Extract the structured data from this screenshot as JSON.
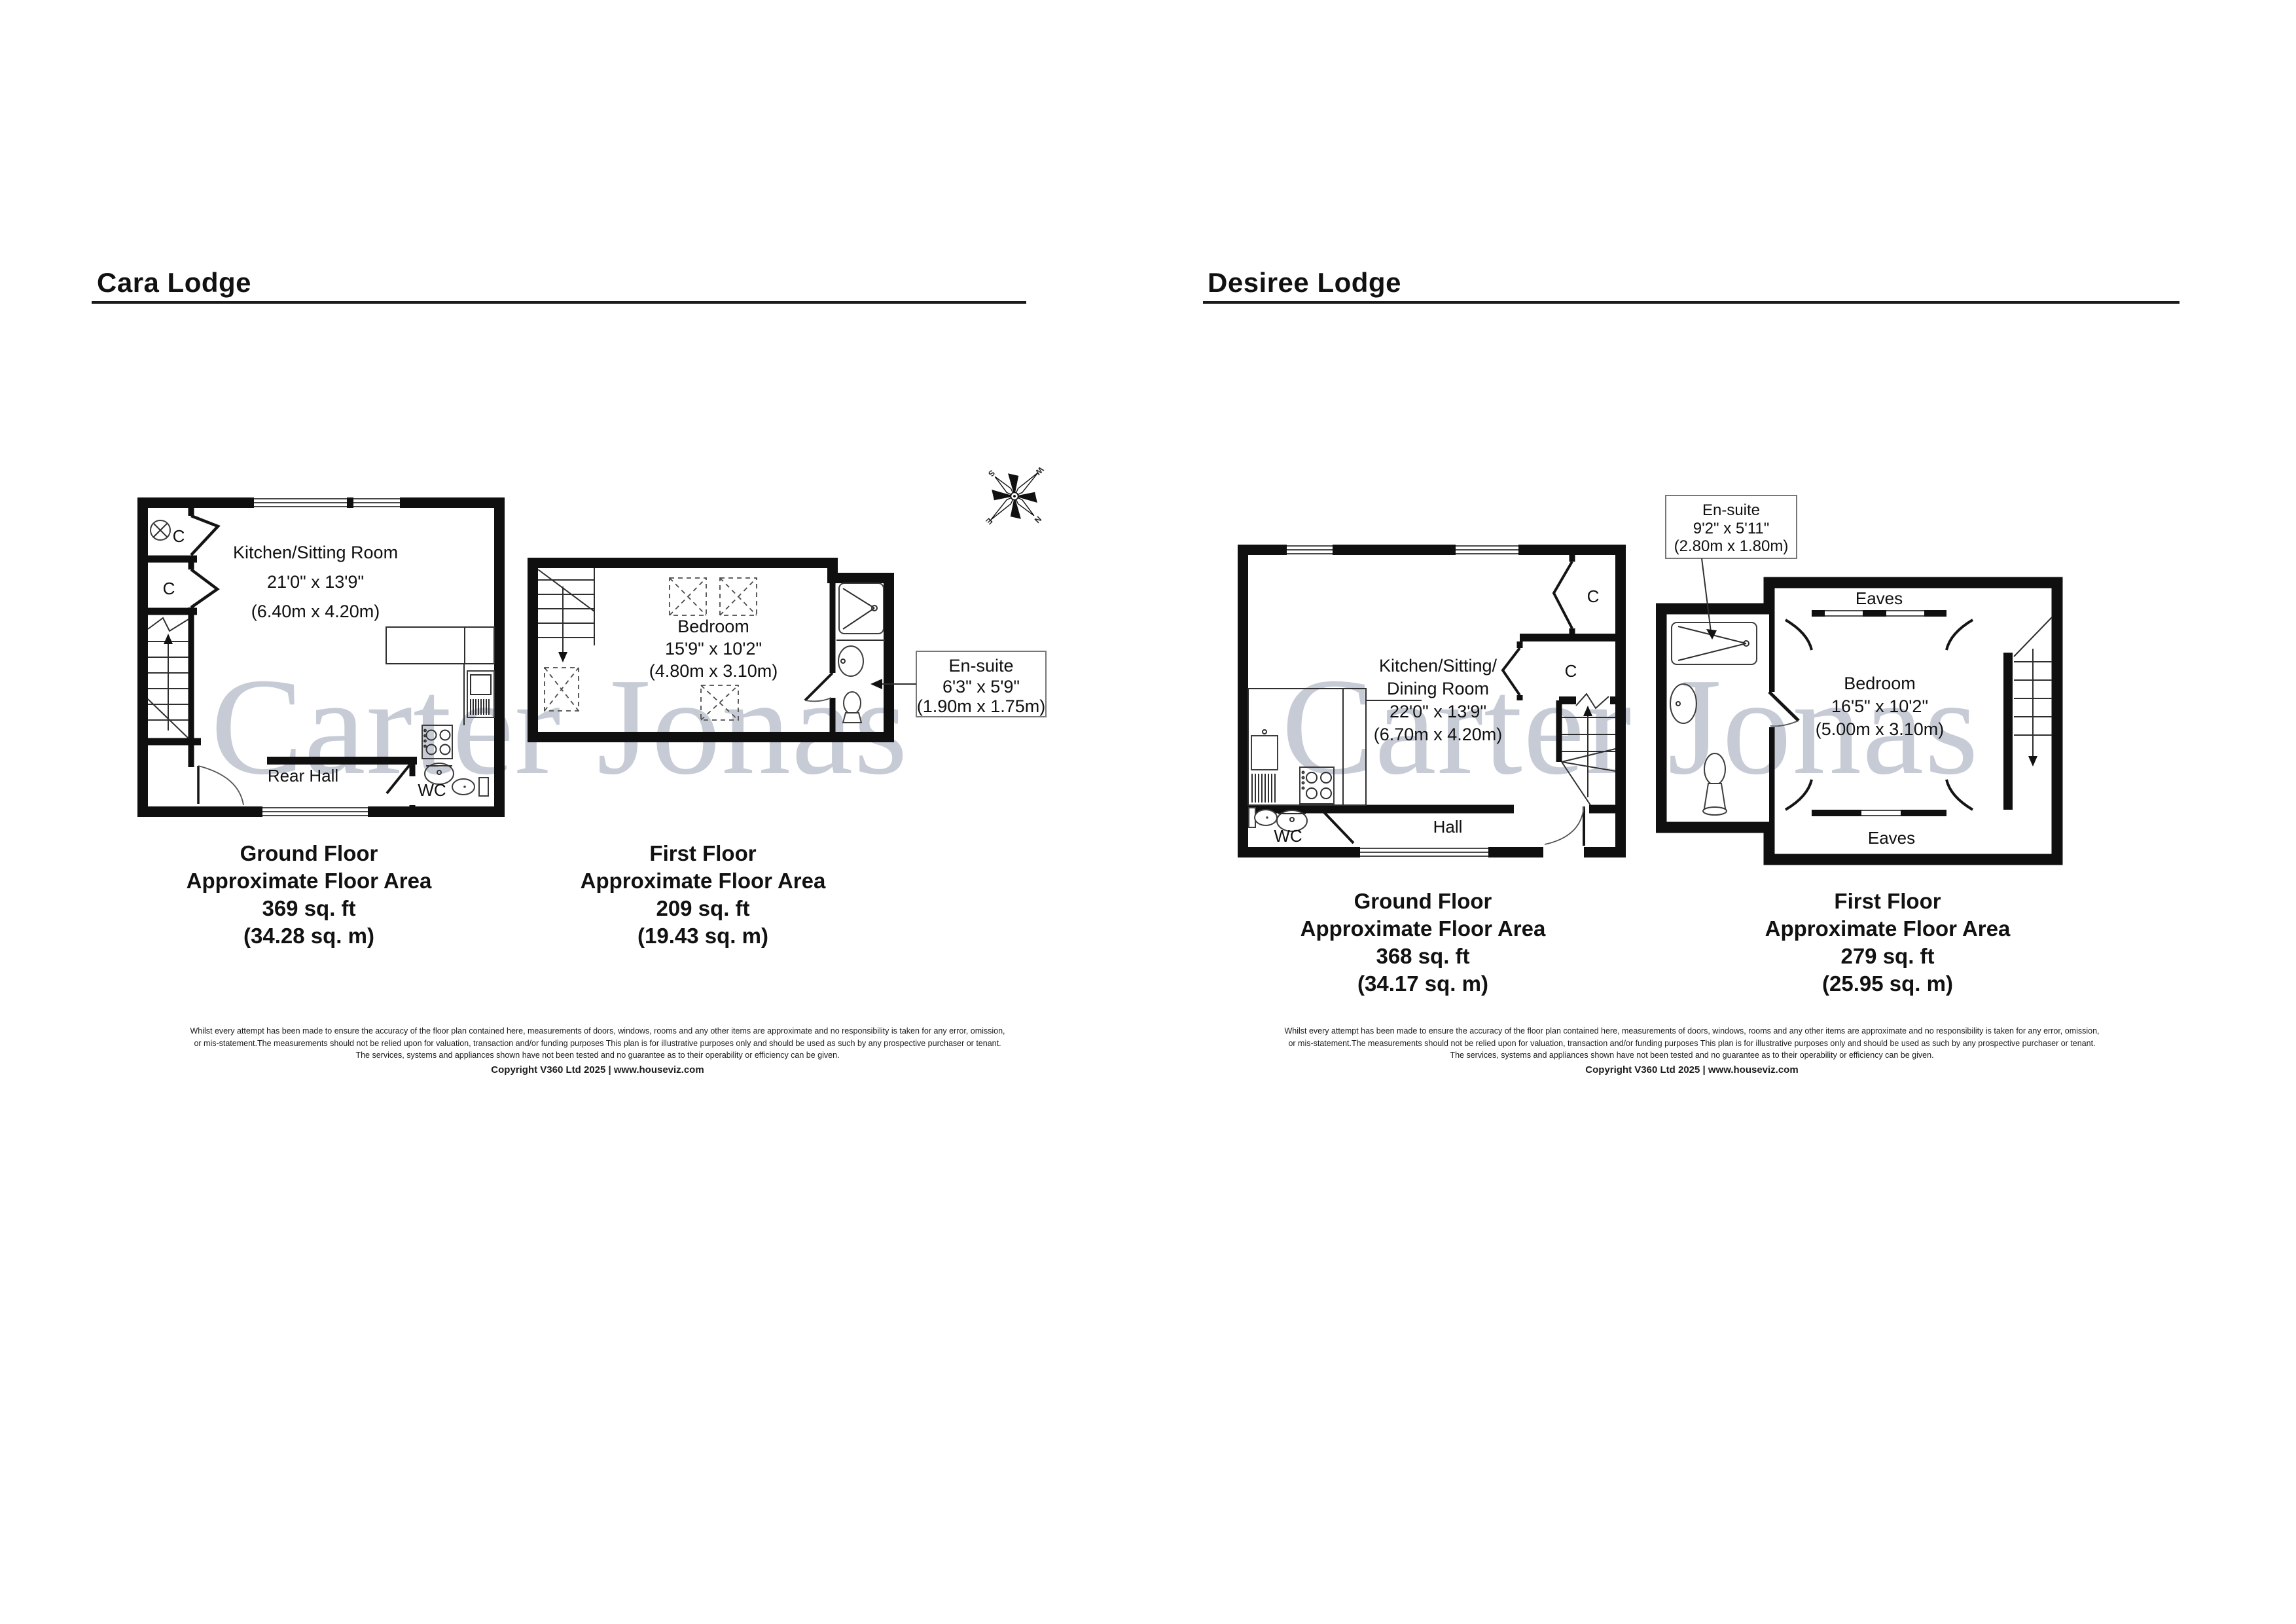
{
  "watermark": "Carter Jonas",
  "compass": {
    "n": "N",
    "e": "E",
    "s": "S",
    "w": "W"
  },
  "disclaimer": {
    "line1": "Whilst every attempt has been made to ensure the accuracy of the floor plan contained here, measurements of doors, windows, rooms and any other items are approximate and no responsibility is taken for any error, omission,",
    "line2": "or mis-statement.The measurements should not be relied upon for valuation, transaction and/or funding purposes This plan is for illustrative purposes only and should be used as such by any prospective purchaser or tenant.",
    "line3": "The services, systems and appliances shown have not been tested and no guarantee as to their operability or efficiency can be given.",
    "copyright": "Copyright V360 Ltd 2025 | www.houseviz.com"
  },
  "cara": {
    "title": "Cara Lodge",
    "ground": {
      "room": "Kitchen/Sitting Room",
      "room_dim_ft": "21'0\" x 13'9\"",
      "room_dim_m": "(6.40m x 4.20m)",
      "hall": "Rear Hall",
      "wc": "WC",
      "closet_top": "C",
      "closet_mid": "C",
      "floor": "Ground Floor",
      "area_label": "Approximate Floor Area",
      "area_ft": "369 sq. ft",
      "area_m": "(34.28 sq. m)"
    },
    "first": {
      "room": "Bedroom",
      "room_dim_ft": "15'9\" x 10'2\"",
      "room_dim_m": "(4.80m x 3.10m)",
      "ensuite": "En-suite",
      "ensuite_dim_ft": "6'3\" x 5'9\"",
      "ensuite_dim_m": "(1.90m x 1.75m)",
      "floor": "First Floor",
      "area_label": "Approximate Floor Area",
      "area_ft": "209 sq. ft",
      "area_m": "(19.43 sq. m)"
    }
  },
  "desiree": {
    "title": "Desiree Lodge",
    "ground": {
      "room_line1": "Kitchen/Sitting/",
      "room_line2": "Dining Room",
      "room_dim_ft": "22'0\" x 13'9\"",
      "room_dim_m": "(6.70m x 4.20m)",
      "hall": "Hall",
      "wc": "WC",
      "closet_top": "C",
      "closet_mid": "C",
      "floor": "Ground Floor",
      "area_label": "Approximate Floor Area",
      "area_ft": "368 sq. ft",
      "area_m": "(34.17 sq. m)"
    },
    "first": {
      "room": "Bedroom",
      "room_dim_ft": "16'5\" x 10'2\"",
      "room_dim_m": "(5.00m x 3.10m)",
      "ensuite": "En-suite",
      "ensuite_dim_ft": "9'2\" x 5'11\"",
      "ensuite_dim_m": "(2.80m x 1.80m)",
      "eaves_top": "Eaves",
      "eaves_bottom": "Eaves",
      "floor": "First Floor",
      "area_label": "Approximate Floor Area",
      "area_ft": "279 sq. ft",
      "area_m": "(25.95 sq. m)"
    }
  }
}
